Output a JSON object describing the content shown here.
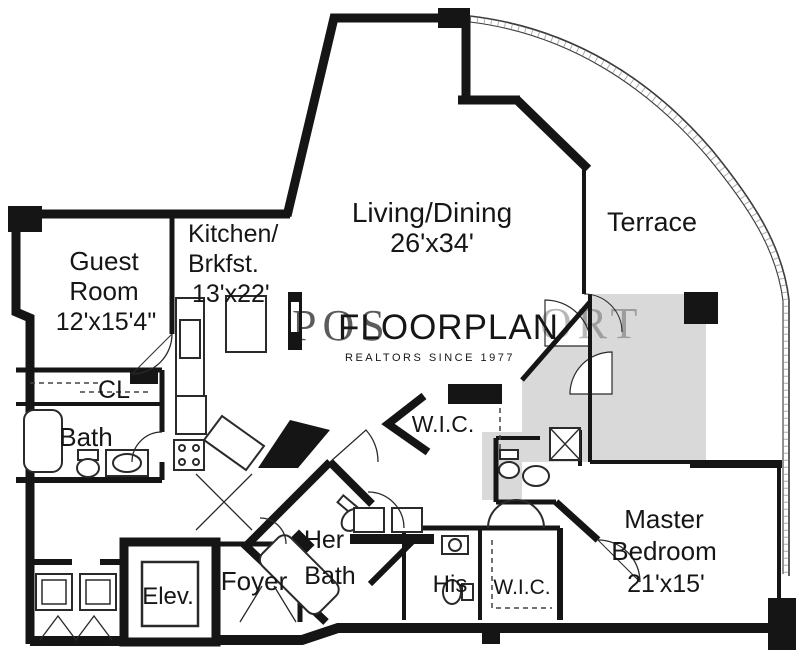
{
  "canvas": {
    "background": "#ffffff",
    "wall_color": "#151515",
    "shade_color": "#d9d9d9",
    "fixture_color": "#2a2a2a"
  },
  "watermark": {
    "title": "FLOORPLAN",
    "subtitle": "REALTORS SINCE 1977",
    "ghost_left": "POS",
    "ghost_right": "ORT",
    "title_color": "#1a1a1a",
    "ghost_color": "#bdbdbd",
    "subtitle_color": "#c6c6c6"
  },
  "rooms": {
    "guest_room": {
      "name_line1": "Guest",
      "name_line2": "Room",
      "dims": "12'x15'4\""
    },
    "kitchen": {
      "name_line1": "Kitchen/",
      "name_line2": "Brkfst.",
      "dims": "13'x22'"
    },
    "living_dining": {
      "name": "Living/Dining",
      "dims": "26'x34'"
    },
    "terrace": {
      "name": "Terrace"
    },
    "closet": {
      "name": "CL"
    },
    "guest_bath": {
      "name": "Bath"
    },
    "wic_upper": {
      "name": "W.I.C."
    },
    "her_bath": {
      "name_line1": "Her",
      "name_line2": "Bath"
    },
    "his_closet": {
      "name": "His"
    },
    "wic_master": {
      "name": "W.I.C."
    },
    "foyer": {
      "name": "Foyer"
    },
    "elevator": {
      "name": "Elev."
    },
    "master_bedroom": {
      "name_line1": "Master",
      "name_line2": "Bedroom",
      "dims": "21'x15'"
    }
  }
}
